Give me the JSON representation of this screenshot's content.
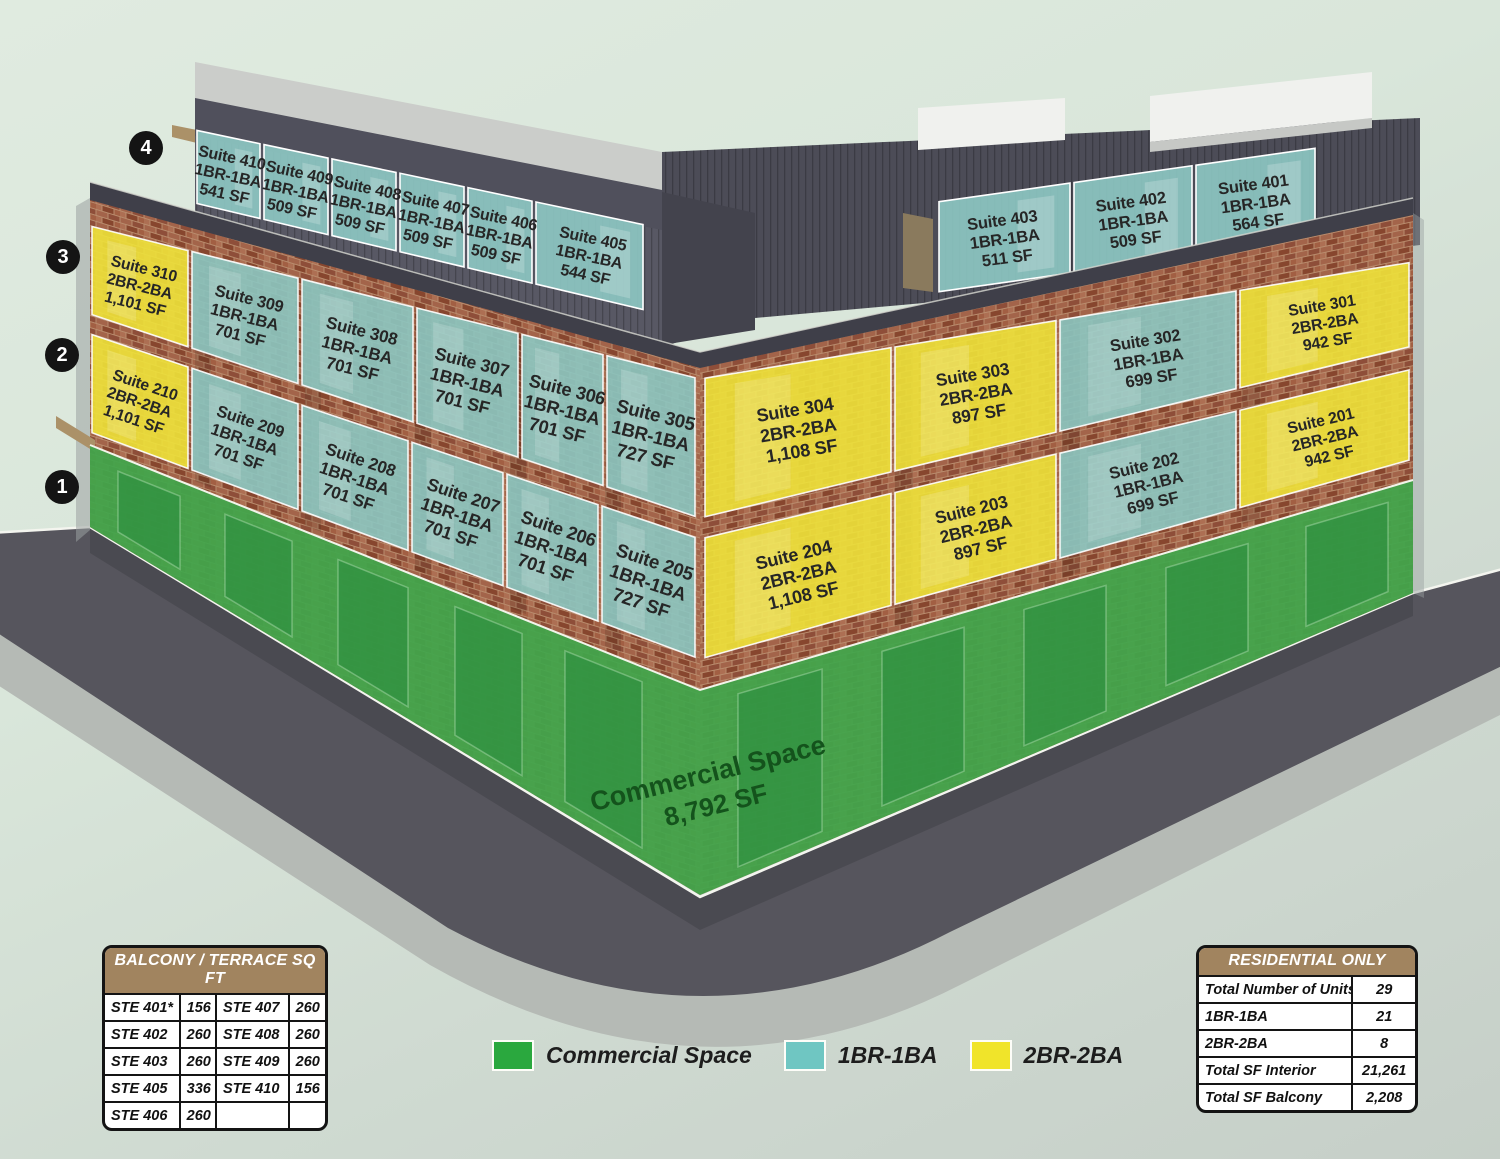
{
  "title": "Mixed-use building suite availability diagram",
  "floor_badges": [
    "4",
    "3",
    "2",
    "1"
  ],
  "commercial_label": {
    "line1": "Commercial Space",
    "line2": "8,792 SF"
  },
  "suites": {
    "410": {
      "name": "Suite 410",
      "type": "1BR-1BA",
      "area": "541 SF"
    },
    "409": {
      "name": "Suite 409",
      "type": "1BR-1BA",
      "area": "509 SF"
    },
    "408": {
      "name": "Suite 408",
      "type": "1BR-1BA",
      "area": "509 SF"
    },
    "407": {
      "name": "Suite 407",
      "type": "1BR-1BA",
      "area": "509 SF"
    },
    "406": {
      "name": "Suite 406",
      "type": "1BR-1BA",
      "area": "509 SF"
    },
    "405": {
      "name": "Suite 405",
      "type": "1BR-1BA",
      "area": "544 SF"
    },
    "403": {
      "name": "Suite 403",
      "type": "1BR-1BA",
      "area": "511 SF"
    },
    "402": {
      "name": "Suite 402",
      "type": "1BR-1BA",
      "area": "509 SF"
    },
    "401": {
      "name": "Suite 401",
      "type": "1BR-1BA",
      "area": "564 SF"
    },
    "310": {
      "name": "Suite 310",
      "type": "2BR-2BA",
      "area": "1,101 SF"
    },
    "309": {
      "name": "Suite 309",
      "type": "1BR-1BA",
      "area": "701 SF"
    },
    "308": {
      "name": "Suite 308",
      "type": "1BR-1BA",
      "area": "701 SF"
    },
    "307": {
      "name": "Suite 307",
      "type": "1BR-1BA",
      "area": "701 SF"
    },
    "306": {
      "name": "Suite 306",
      "type": "1BR-1BA",
      "area": "701 SF"
    },
    "305": {
      "name": "Suite 305",
      "type": "1BR-1BA",
      "area": "727 SF"
    },
    "304": {
      "name": "Suite 304",
      "type": "2BR-2BA",
      "area": "1,108 SF"
    },
    "303": {
      "name": "Suite 303",
      "type": "2BR-2BA",
      "area": "897 SF"
    },
    "302": {
      "name": "Suite 302",
      "type": "1BR-1BA",
      "area": "699 SF"
    },
    "301": {
      "name": "Suite 301",
      "type": "2BR-2BA",
      "area": "942 SF"
    },
    "210": {
      "name": "Suite 210",
      "type": "2BR-2BA",
      "area": "1,101 SF"
    },
    "209": {
      "name": "Suite 209",
      "type": "1BR-1BA",
      "area": "701 SF"
    },
    "208": {
      "name": "Suite 208",
      "type": "1BR-1BA",
      "area": "701 SF"
    },
    "207": {
      "name": "Suite 207",
      "type": "1BR-1BA",
      "area": "701 SF"
    },
    "206": {
      "name": "Suite 206",
      "type": "1BR-1BA",
      "area": "701 SF"
    },
    "205": {
      "name": "Suite 205",
      "type": "1BR-1BA",
      "area": "727 SF"
    },
    "204": {
      "name": "Suite 204",
      "type": "2BR-2BA",
      "area": "1,108 SF"
    },
    "203": {
      "name": "Suite 203",
      "type": "2BR-2BA",
      "area": "897 SF"
    },
    "202": {
      "name": "Suite 202",
      "type": "1BR-1BA",
      "area": "699 SF"
    },
    "201": {
      "name": "Suite 201",
      "type": "2BR-2BA",
      "area": "942 SF"
    }
  },
  "legend": {
    "items": [
      {
        "label": "Commercial Space",
        "color": "#2aa83e"
      },
      {
        "label": "1BR-1BA",
        "color": "#6fc6c2"
      },
      {
        "label": "2BR-2BA",
        "color": "#f0e42a"
      }
    ]
  },
  "balcony_table": {
    "title": "BALCONY / TERRACE SQ FT",
    "rows": [
      [
        "STE 401*",
        "156",
        "STE 407",
        "260"
      ],
      [
        "STE 402",
        "260",
        "STE 408",
        "260"
      ],
      [
        "STE 403",
        "260",
        "STE 409",
        "260"
      ],
      [
        "STE 405",
        "336",
        "STE 410",
        "156"
      ],
      [
        "STE 406",
        "260",
        "",
        ""
      ]
    ]
  },
  "residential_table": {
    "title": "RESIDENTIAL ONLY",
    "rows": [
      [
        "Total Number of Units",
        "29"
      ],
      [
        "1BR-1BA",
        "21"
      ],
      [
        "2BR-2BA",
        "8"
      ],
      [
        "Total SF Interior",
        "21,261"
      ],
      [
        "Total SF Balcony",
        "2,208"
      ]
    ]
  },
  "theme": {
    "teal_panel": "#8cc6c1",
    "yellow_panel": "#eee23a",
    "green_wall": "#41a64b",
    "storefront": "#2e9040",
    "commercial_text": "#14531c",
    "brick_mortar": "#b98c6d",
    "street": "#56555d",
    "sidewalk": "#b5bab5",
    "roof_dark": "#50505c",
    "roof_light": "#cbcdca",
    "white_slab": "#f0f1ee",
    "tan": "#ab9168",
    "parapet": "#3f3f49"
  }
}
